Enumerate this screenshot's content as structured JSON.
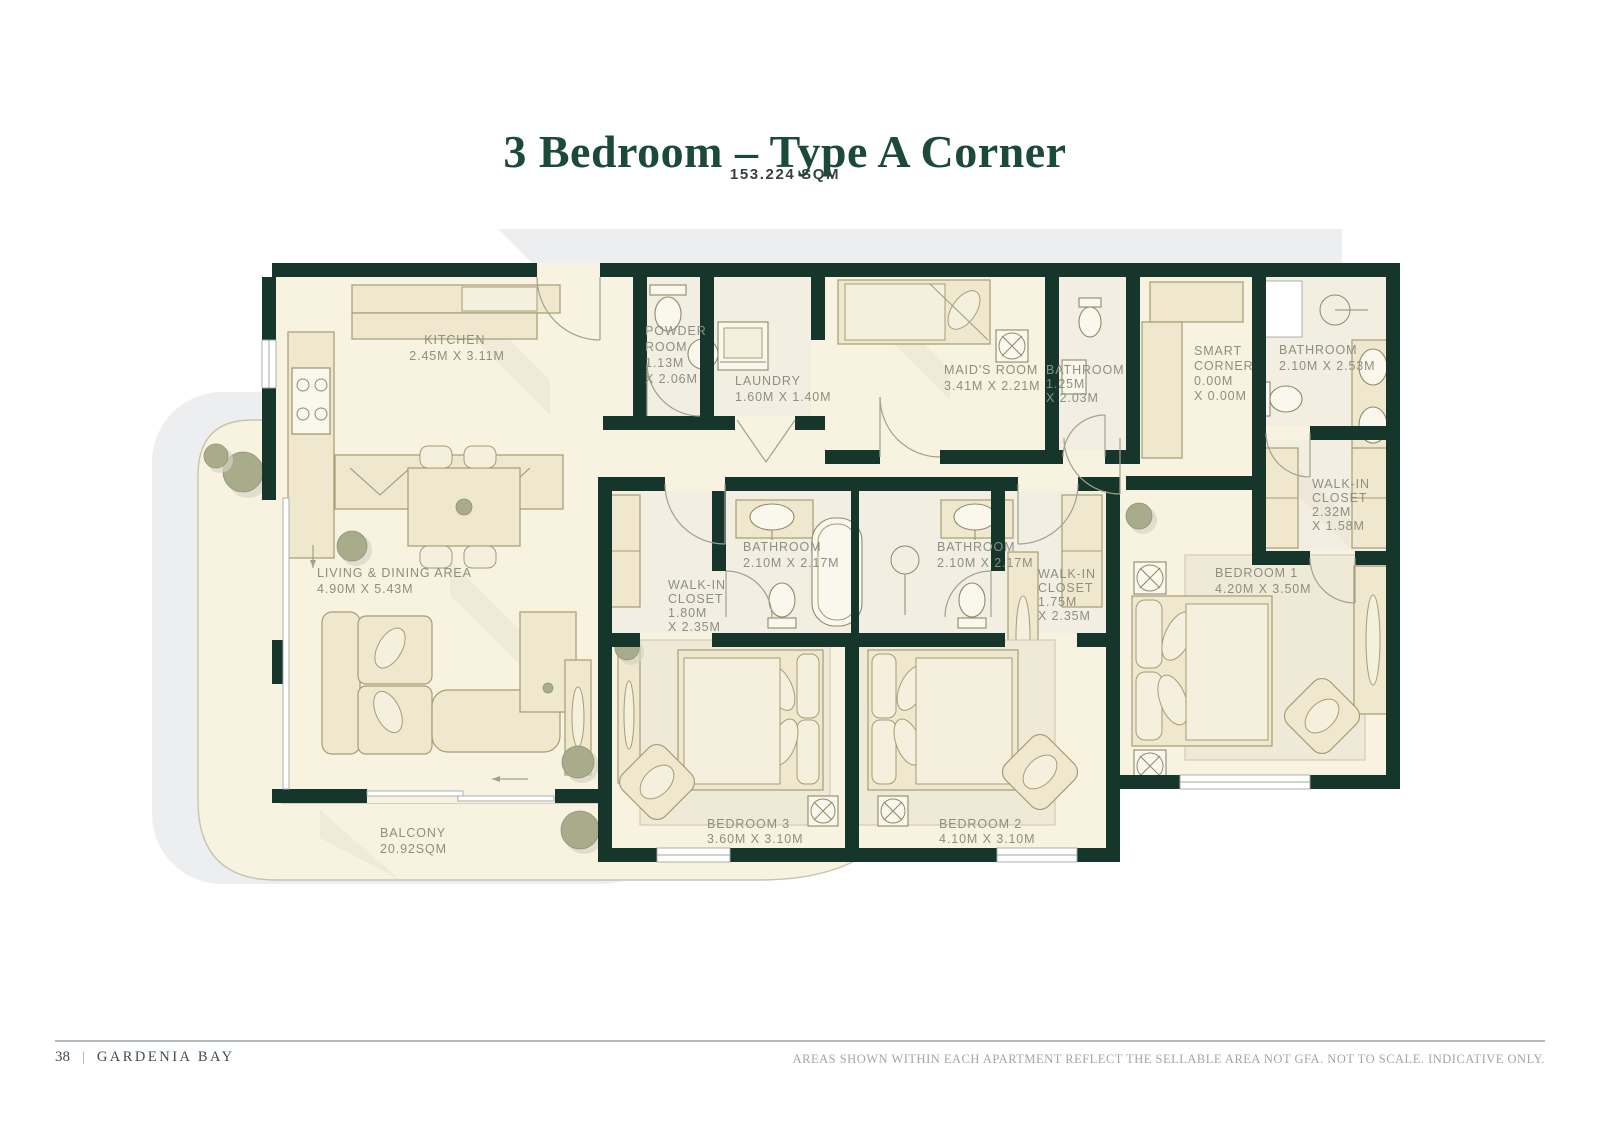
{
  "header": {
    "title": "3 Bedroom – Type A Corner",
    "area": "153.224 SQM"
  },
  "rooms": {
    "kitchen": {
      "lines": [
        "KITCHEN",
        "2.45M X 3.11M"
      ]
    },
    "powder_room": {
      "lines": [
        "POWDER",
        "ROOM",
        "1.13M",
        "X 2.06M"
      ]
    },
    "laundry": {
      "lines": [
        "LAUNDRY",
        "1.60M X 1.40M"
      ]
    },
    "maids_room": {
      "lines": [
        "MAID'S ROOM",
        "3.41M X 2.21M"
      ]
    },
    "maids_bathroom": {
      "lines": [
        "BATHROOM",
        "1.25M",
        "X 2.03M"
      ]
    },
    "smart_corner": {
      "lines": [
        "SMART",
        "CORNER",
        "0.00M",
        "X 0.00M"
      ]
    },
    "bathroom_1": {
      "lines": [
        "BATHROOM",
        "2.10M X 2.53M"
      ]
    },
    "walkin_closet_1": {
      "lines": [
        "WALK-IN",
        "CLOSET",
        "2.32M",
        "X 1.58M"
      ]
    },
    "bedroom_1": {
      "lines": [
        "BEDROOM 1",
        "4.20M X 3.50M"
      ]
    },
    "bathroom_3": {
      "lines": [
        "BATHROOM",
        "2.10M X 2.17M"
      ]
    },
    "bathroom_2": {
      "lines": [
        "BATHROOM",
        "2.10M X 2.17M"
      ]
    },
    "walkin_closet_3": {
      "lines": [
        "WALK-IN",
        "CLOSET",
        "1.80M",
        "X 2.35M"
      ]
    },
    "walkin_closet_2": {
      "lines": [
        "WALK-IN",
        "CLOSET",
        "1.75M",
        "X 2.35M"
      ]
    },
    "living_dining": {
      "lines": [
        "LIVING & DINING AREA",
        "4.90M X 5.43M"
      ]
    },
    "balcony": {
      "lines": [
        "BALCONY",
        "20.92SQM"
      ]
    },
    "bedroom_3": {
      "lines": [
        "BEDROOM 3",
        "3.60M X 3.10M"
      ]
    },
    "bedroom_2": {
      "lines": [
        "BEDROOM 2",
        "4.10M X 3.10M"
      ]
    }
  },
  "footer": {
    "page_number": "38",
    "separator": "|",
    "brand": "GARDENIA BAY",
    "disclaimer": "AREAS SHOWN WITHIN EACH APARTMENT REFLECT THE SELLABLE AREA NOT GFA. NOT TO SCALE. INDICATIVE ONLY."
  },
  "colors": {
    "wall": "#16352B",
    "floor": "#F8F2E1",
    "furniture": "#F0E8CE",
    "label": "#8C9080",
    "title_green": "#1C4A3A",
    "plant": "#A9AC8B",
    "shadow_gray": "#ECEEEF"
  }
}
